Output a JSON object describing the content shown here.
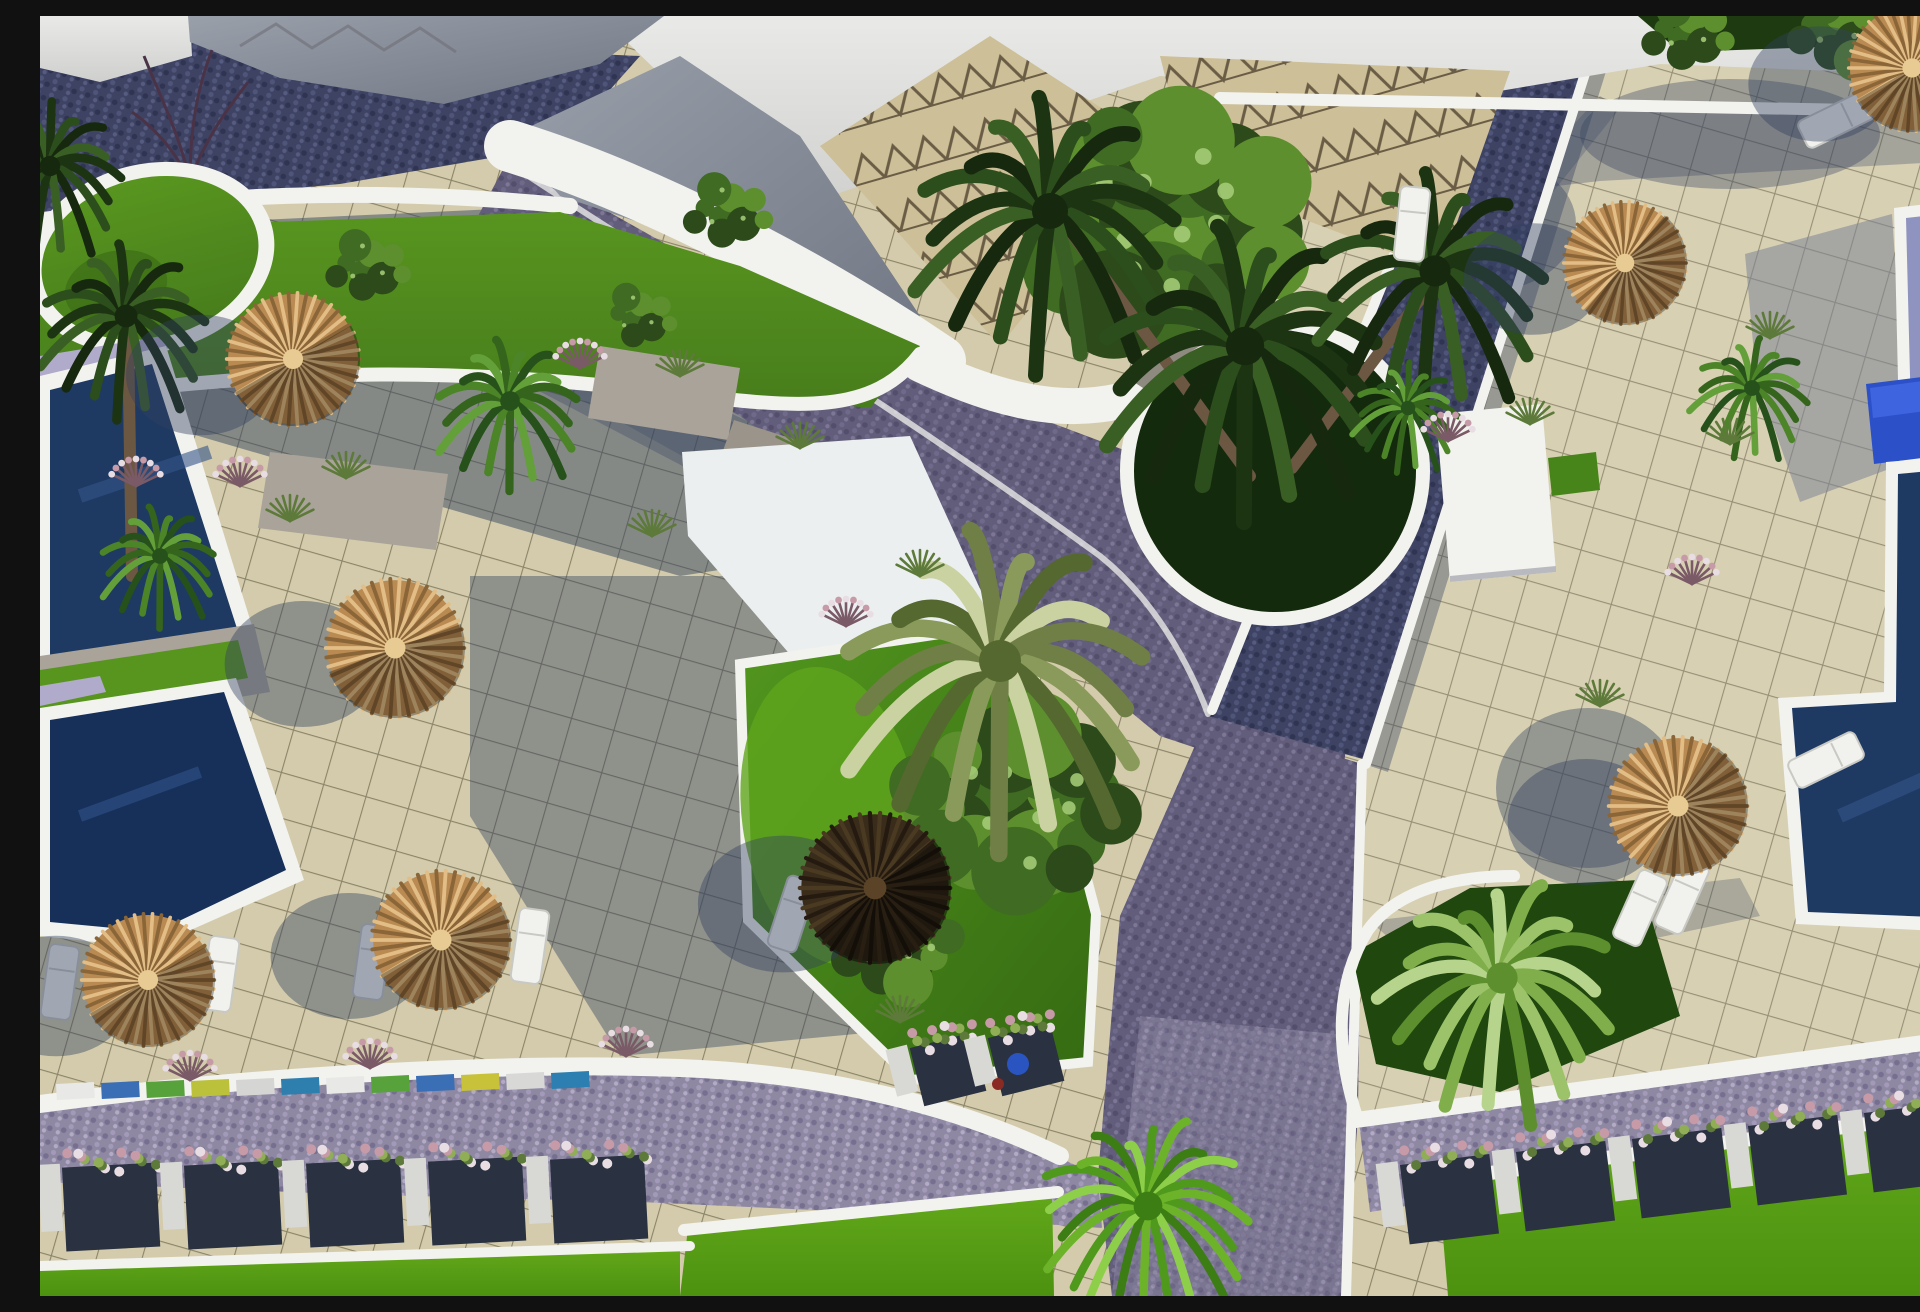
{
  "meta": {
    "title": "Aerial 3D architectural rendering of a resort courtyard",
    "view": "top-down aerial",
    "scene_summary": "Tiled plazas with thatched parasols and white loungers, navy cobblestone paths, swimming pools on left and right edges, curved white walls, palm trees, green planters and flower boxes along a lower road"
  },
  "palette": {
    "tile": "#d3cbab",
    "tileLine": "#8c8468",
    "cobbleDark": "#3e4364",
    "cobbleDarkA": "#4f5578",
    "cobbleDarkB": "#2f3452",
    "cobbleMid": "#625d7a",
    "cobbleMidA": "#6f6a8a",
    "cobbleMidB": "#544e6d",
    "cobbleLight": "#8e88a2",
    "cobbleLightA": "#a29ab8",
    "cobbleLightB": "#766f90",
    "white": "#f2f2ee",
    "sky1": "#e9e9e7",
    "sky2": "#cfd0ce",
    "roofTile": "#cdbf97",
    "roofLine": "#6a5d45",
    "roofGray1": "#9aa0aa",
    "roofGray2": "#6f7582",
    "poolNavy": "#1e3a63",
    "poolNavyDeep": "#16305a",
    "poolLavender": "#8f93c0",
    "poolBlue": "#2b50c8",
    "deckLavender": "#b0aacb",
    "grassDark": "#477d1c",
    "grassMid": "#58951f",
    "lawn1": "#63a81a",
    "lawn2": "#4c9210",
    "bedGreen": "#47851b",
    "bedDark": "#1f470e",
    "bushDark": "#2c4a1a",
    "bushMid": "#3f6b22",
    "bushLight": "#5d8f2e",
    "bushGlint": "#a8cf7a",
    "thatchBase": "#b98a52",
    "thatchLight": "#e2bd85",
    "thatchMid": "#c99a5e",
    "thatchDark": "#8a6538",
    "umbDark1": "#241a10",
    "umbDark2": "#3a2c1a",
    "flowerPink": "#c79aa8",
    "flowerWhite": "#e8dde2",
    "stems": "#5d7a3a",
    "stone": "#a9a399",
    "stoneTop": "#c4beb2",
    "boxDark": "#2a3140",
    "pillar": "#d8d8d4",
    "trunk": "#6b5742"
  },
  "scene": {
    "umbrellas": [
      {
        "x": 253,
        "y": 343,
        "r": 67,
        "kind": "thatch",
        "shade": 150
      },
      {
        "x": 355,
        "y": 632,
        "r": 70,
        "kind": "thatch",
        "shade": 160
      },
      {
        "x": 108,
        "y": 964,
        "r": 67,
        "kind": "thatch",
        "shade": 150
      },
      {
        "x": 401,
        "y": 924,
        "r": 70,
        "kind": "thatch",
        "shade": 150
      },
      {
        "x": 835,
        "y": 872,
        "r": 76,
        "kind": "dark",
        "shade": 140
      },
      {
        "x": 1638,
        "y": 790,
        "r": 70,
        "kind": "thatch",
        "shade": 120
      },
      {
        "x": 1585,
        "y": 247,
        "r": 62,
        "kind": "thatch",
        "shade": 130
      },
      {
        "x": 1872,
        "y": 52,
        "r": 64,
        "kind": "thatch",
        "shade": 150
      }
    ],
    "palms": [
      {
        "x": 1010,
        "y": 195,
        "r": 150,
        "kind": "dark"
      },
      {
        "x": 1205,
        "y": 330,
        "r": 160,
        "kind": "dark"
      },
      {
        "x": 1395,
        "y": 255,
        "r": 130,
        "kind": "dark"
      },
      {
        "x": 960,
        "y": 645,
        "r": 175,
        "kind": "olive"
      },
      {
        "x": 1108,
        "y": 1190,
        "r": 120,
        "kind": "bright"
      },
      {
        "x": 1462,
        "y": 962,
        "r": 130,
        "kind": "light"
      },
      {
        "x": 86,
        "y": 300,
        "r": 95,
        "kind": "dark"
      },
      {
        "x": 10,
        "y": 150,
        "r": 85,
        "kind": "dark"
      },
      {
        "x": 470,
        "y": 385,
        "r": 82,
        "kind": "mid"
      },
      {
        "x": 120,
        "y": 540,
        "r": 66,
        "kind": "mid"
      },
      {
        "x": 1368,
        "y": 392,
        "r": 60,
        "kind": "mid"
      },
      {
        "x": 1712,
        "y": 372,
        "r": 66,
        "kind": "mid"
      }
    ],
    "trunks": [
      {
        "x1": 1210,
        "y1": 460,
        "x2": 1030,
        "y2": 215
      },
      {
        "x1": 1252,
        "y1": 452,
        "x2": 1390,
        "y2": 270
      },
      {
        "x1": 92,
        "y1": 560,
        "x2": 88,
        "y2": 318
      }
    ],
    "bushes": [
      {
        "x": 1118,
        "y": 205,
        "r": 185,
        "n": 30
      },
      {
        "x": 978,
        "y": 790,
        "r": 150,
        "n": 26
      },
      {
        "x": 330,
        "y": 250,
        "r": 55,
        "n": 10
      },
      {
        "x": 600,
        "y": 300,
        "r": 48,
        "n": 9
      },
      {
        "x": 690,
        "y": 195,
        "r": 58,
        "n": 10
      },
      {
        "x": 852,
        "y": 930,
        "r": 85,
        "n": 14
      },
      {
        "x": 1650,
        "y": 16,
        "r": 60,
        "n": 10
      },
      {
        "x": 1800,
        "y": 12,
        "r": 70,
        "n": 12
      }
    ],
    "tufts": [
      {
        "x": 540,
        "y": 352,
        "c": "pink"
      },
      {
        "x": 200,
        "y": 470,
        "c": "pink"
      },
      {
        "x": 96,
        "y": 470,
        "c": "pink"
      },
      {
        "x": 612,
        "y": 520,
        "c": "grass"
      },
      {
        "x": 250,
        "y": 505,
        "c": "grass"
      },
      {
        "x": 306,
        "y": 462,
        "c": "grass"
      },
      {
        "x": 760,
        "y": 432,
        "c": "grass"
      },
      {
        "x": 806,
        "y": 610,
        "c": "pink"
      },
      {
        "x": 880,
        "y": 560,
        "c": "grass"
      },
      {
        "x": 1408,
        "y": 425,
        "c": "pink"
      },
      {
        "x": 1490,
        "y": 408,
        "c": "grass"
      },
      {
        "x": 1690,
        "y": 428,
        "c": "grass"
      },
      {
        "x": 1730,
        "y": 322,
        "c": "grass"
      },
      {
        "x": 1652,
        "y": 568,
        "c": "pink"
      },
      {
        "x": 586,
        "y": 1040,
        "c": "pink"
      },
      {
        "x": 330,
        "y": 1052,
        "c": "pink"
      },
      {
        "x": 150,
        "y": 1064,
        "c": "pink"
      },
      {
        "x": 860,
        "y": 1006,
        "c": "grass"
      },
      {
        "x": 1560,
        "y": 690,
        "c": "grass"
      },
      {
        "x": 640,
        "y": 360,
        "c": "grass"
      }
    ],
    "loungers": [
      {
        "x": 20,
        "y": 966,
        "rot": 8
      },
      {
        "x": 180,
        "y": 958,
        "rot": 8
      },
      {
        "x": 332,
        "y": 946,
        "rot": 8
      },
      {
        "x": 490,
        "y": 930,
        "rot": 8
      },
      {
        "x": 1786,
        "y": 744,
        "rot": 64
      },
      {
        "x": 1642,
        "y": 880,
        "rot": 24
      },
      {
        "x": 1600,
        "y": 892,
        "rot": 24
      },
      {
        "x": 1372,
        "y": 208,
        "rot": 6
      },
      {
        "x": 752,
        "y": 898,
        "rot": 18
      },
      {
        "x": 1796,
        "y": 104,
        "rot": 64
      }
    ],
    "planter_rows": [
      {
        "x0": 14,
        "y0": 1152,
        "dx": 122,
        "dy": -2,
        "w": 94,
        "h": 84,
        "rot": -3,
        "count": 5
      },
      {
        "x0": 1352,
        "y0": 1150,
        "dx": 116,
        "dy": -13,
        "w": 90,
        "h": 80,
        "rot": -7,
        "count": 5
      },
      {
        "x0": 862,
        "y0": 1034,
        "dx": 78,
        "dy": -10,
        "w": 64,
        "h": 60,
        "rot": -14,
        "count": 2
      }
    ],
    "color_strip": {
      "x0": 16,
      "y0": 1068,
      "dx": 45,
      "dy": -1,
      "w": 38,
      "h": 16,
      "rot": -3,
      "colors": [
        "#e8e8e6",
        "#3a6fb5",
        "#58a23c",
        "#bcc13c",
        "#d5d5d3",
        "#2f7fae",
        "#e8e8e6",
        "#58a23c",
        "#3a6fb5",
        "#c8c23a",
        "#d8d8d6",
        "#2c7fb0"
      ]
    },
    "pots": [
      {
        "x": 978,
        "y": 1048,
        "r": 11,
        "color": "#2a55c0"
      },
      {
        "x": 958,
        "y": 1068,
        "r": 6,
        "color": "#8a2a22"
      }
    ],
    "counts": {
      "pools_left": 2,
      "pools_right": 2,
      "round_planters": 2,
      "umbrellas": 8,
      "palm_trees": 12
    }
  }
}
